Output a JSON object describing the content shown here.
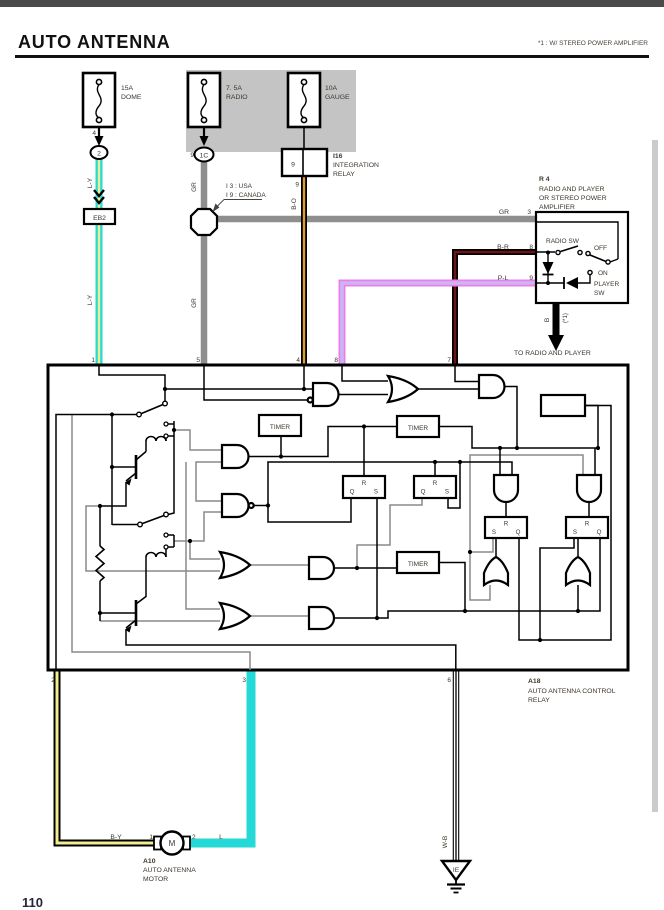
{
  "header": {
    "title": "AUTO ANTENNA",
    "note": "*1 : W/ STEREO POWER AMPLIFIER",
    "page_number": "110"
  },
  "fuses": {
    "dome": {
      "rating": "15A",
      "name": "DOME",
      "pin": "4",
      "connector": "2"
    },
    "radio": {
      "rating": "7. 5A",
      "name": "RADIO",
      "pin": "9",
      "connector": "1C"
    },
    "gauge": {
      "rating": "10A",
      "name": "GAUGE"
    }
  },
  "integration_relay": {
    "code": "I16",
    "name1": "INTEGRATION",
    "name2": "RELAY",
    "pin": "9",
    "pin_below": "9"
  },
  "market_note": {
    "line1": "I 3 : USA",
    "line2": "I 9 : CANADA"
  },
  "eb2": {
    "pin": "2",
    "label": "EB2"
  },
  "wires": {
    "ly": "L-Y",
    "gr": "GR",
    "bo": "B-O",
    "br": "B-R",
    "pl": "P-L",
    "by": "B-Y",
    "l": "L",
    "wb": "W-B",
    "b": "B"
  },
  "r4": {
    "code": "R 4",
    "name1": "RADIO AND PLAYER",
    "name2": "OR STEREO POWER",
    "name3": "AMPLIFIER",
    "radio_sw": "RADIO SW",
    "off": "OFF",
    "on": "ON",
    "player1": "PLAYER",
    "player2": "SW",
    "pin_gr": "3",
    "pin_br": "8",
    "pin_pl": "9",
    "out_note": "(*1)",
    "to_text": "TO RADIO AND PLAYER"
  },
  "a18": {
    "code": "A18",
    "name1": "AUTO ANTENNA CONTROL",
    "name2": "RELAY",
    "pin1": "1",
    "pin5": "5",
    "pin4": "4",
    "pin8": "8",
    "pin7": "7",
    "pin2": "2",
    "pin3": "3",
    "pin6": "6",
    "timer": "TIMER",
    "q": "Q",
    "r": "R",
    "s": "S"
  },
  "a10": {
    "code": "A10",
    "name1": "AUTO ANTENNA",
    "name2": "MOTOR",
    "motor": "M",
    "pin_left": "1",
    "pin_right": "2"
  },
  "ground": {
    "label": "IE"
  },
  "colors": {
    "cyan": "#24d9d6",
    "stripe_yellow": "#f2ee8e",
    "wire_gray": "#8e8e8e",
    "orange": "#de9c33",
    "maroon": "#6d1414",
    "pink": "#ee7ce6",
    "violet": "#c9b6f5",
    "panel": "#c4c4c4",
    "bar": "#4a4a4a"
  }
}
